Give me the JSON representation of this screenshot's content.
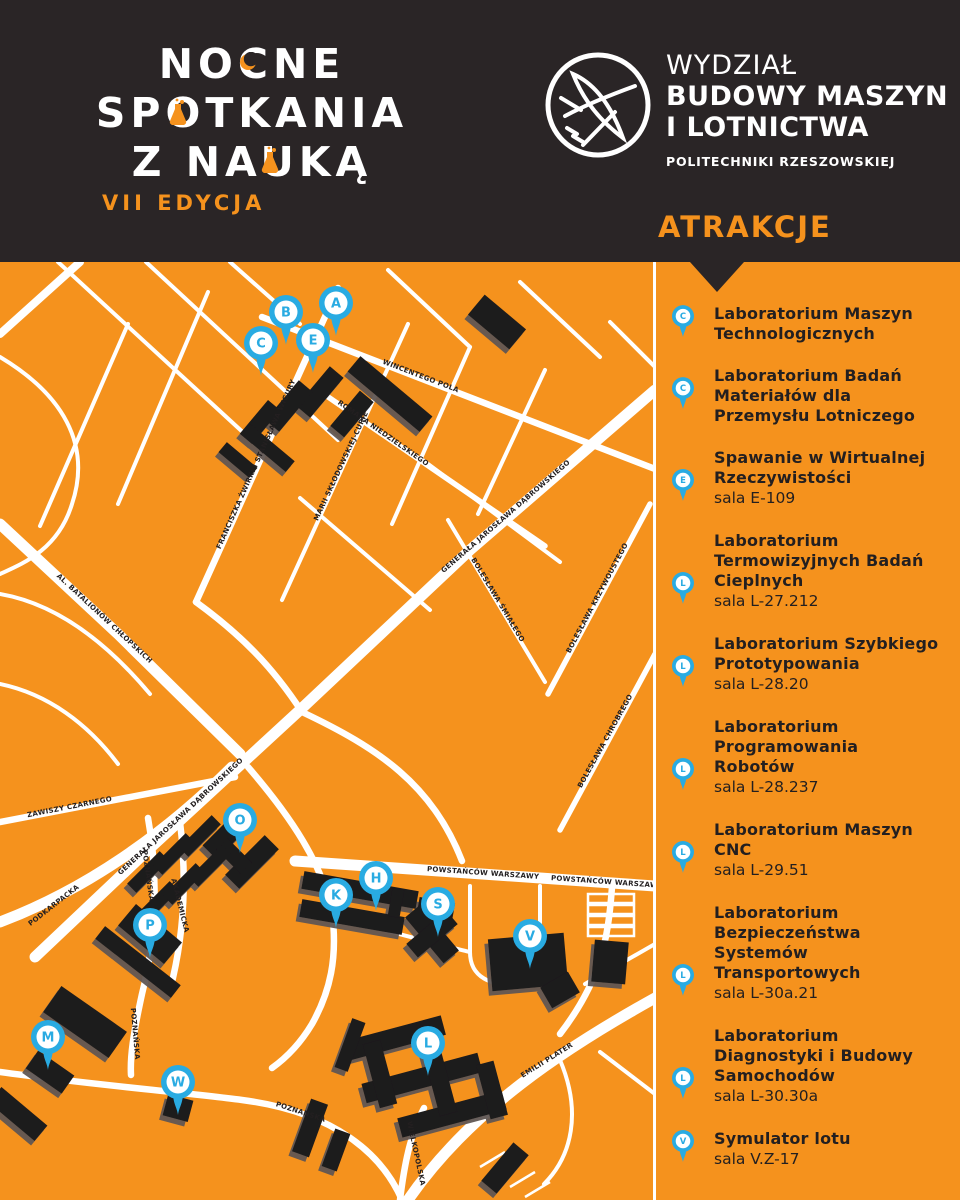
{
  "colors": {
    "orange": "#F5921D",
    "dark": "#2A2526",
    "blue": "#29ABE2",
    "white": "#FFFFFF",
    "ink": "#231F20"
  },
  "poster": {
    "logo": {
      "line1": "NOCNE",
      "line2": "SPOTKANIA",
      "line3": "Z NAUKĄ",
      "edition": "VII EDYCJA"
    },
    "faculty": {
      "line1": "WYDZIAŁ",
      "line2": "BUDOWY MASZYN",
      "line3": "I LOTNICTWA",
      "line4": "POLITECHNIKI RZESZOWSKIEJ"
    },
    "attractions_heading": "ATRAKCJE"
  },
  "map": {
    "pins": [
      {
        "letter": "A",
        "x": 336,
        "y": 41
      },
      {
        "letter": "B",
        "x": 286,
        "y": 50
      },
      {
        "letter": "C",
        "x": 261,
        "y": 81
      },
      {
        "letter": "E",
        "x": 313,
        "y": 78
      },
      {
        "letter": "O",
        "x": 240,
        "y": 558
      },
      {
        "letter": "K",
        "x": 336,
        "y": 633
      },
      {
        "letter": "H",
        "x": 376,
        "y": 616
      },
      {
        "letter": "S",
        "x": 438,
        "y": 642
      },
      {
        "letter": "V",
        "x": 530,
        "y": 674
      },
      {
        "letter": "P",
        "x": 150,
        "y": 663
      },
      {
        "letter": "M",
        "x": 48,
        "y": 775
      },
      {
        "letter": "W",
        "x": 178,
        "y": 820
      },
      {
        "letter": "L",
        "x": 428,
        "y": 781
      }
    ],
    "street_labels": [
      {
        "name": "WINCENTEGO POLA",
        "x": 420,
        "y": 116,
        "rot": 21
      },
      {
        "name": "ROMANA NIEDZIELSKIEGO",
        "x": 382,
        "y": 173,
        "rot": 35
      },
      {
        "name": "FRANCISZKA ŻWIRKI I STANISŁAWA WIGURY",
        "x": 258,
        "y": 203,
        "rot": -66
      },
      {
        "name": "MARII SKŁODOWSKIEJ-CURIE",
        "x": 343,
        "y": 205,
        "rot": -65
      },
      {
        "name": "GENERAŁA JAROSŁAWA DĄBROWSKIEGO",
        "x": 507,
        "y": 256,
        "rot": -41
      },
      {
        "name": "GENERAŁA JAROSŁAWA DĄBROWSKIEGO",
        "x": 182,
        "y": 556,
        "rot": -43
      },
      {
        "name": "AL. BATALIONÓW CHŁOPSKICH",
        "x": 103,
        "y": 358,
        "rot": 43
      },
      {
        "name": "PODKARPACKA",
        "x": 55,
        "y": 645,
        "rot": -38
      },
      {
        "name": "BOLESŁAWA KRZYWOUSTEGO",
        "x": 599,
        "y": 337,
        "rot": -62
      },
      {
        "name": "BOLESŁAWA CHROBREGO",
        "x": 607,
        "y": 480,
        "rot": -61
      },
      {
        "name": "BOLESŁAWA ŚMIAŁEGO",
        "x": 496,
        "y": 339,
        "rot": 59
      },
      {
        "name": "ZAWISZY CZARNEGO",
        "x": 70,
        "y": 547,
        "rot": -11
      },
      {
        "name": "POWSTAŃCÓW WARSZAWY",
        "x": 483,
        "y": 613,
        "rot": 4
      },
      {
        "name": "POWSTAŃCÓW WARSZAWY",
        "x": 607,
        "y": 622,
        "rot": 4
      },
      {
        "name": "EMILII PLATER",
        "x": 548,
        "y": 800,
        "rot": -32
      },
      {
        "name": "POZNAŃSKA",
        "x": 146,
        "y": 614,
        "rot": 82
      },
      {
        "name": "AKADEMICKA",
        "x": 178,
        "y": 644,
        "rot": 76
      },
      {
        "name": "POZNAŃSKA",
        "x": 133,
        "y": 772,
        "rot": 85
      },
      {
        "name": "POZNAŃSKA",
        "x": 300,
        "y": 852,
        "rot": 18
      },
      {
        "name": "WIELKOPOLSKA",
        "x": 414,
        "y": 892,
        "rot": 78
      }
    ]
  },
  "sidebar": {
    "items": [
      {
        "pin": "C",
        "title": "Laboratorium Maszyn\nTechnologicznych",
        "room": ""
      },
      {
        "pin": "C",
        "title": "Laboratorium Badań\nMateriałów dla\nPrzemysłu Lotniczego",
        "room": ""
      },
      {
        "pin": "E",
        "title": "Spawanie w Wirtualnej\nRzeczywistości",
        "room": "sala E-109"
      },
      {
        "pin": "L",
        "title": "Laboratorium\nTermowizyjnych Badań\nCieplnych",
        "room": "sala L-27.212"
      },
      {
        "pin": "L",
        "title": "Laboratorium Szybkiego\nPrototypowania",
        "room": "sala L-28.20"
      },
      {
        "pin": "L",
        "title": "Laboratorium\nProgramowania\nRobotów",
        "room": "sala L-28.237"
      },
      {
        "pin": "L",
        "title": "Laboratorium Maszyn\nCNC",
        "room": "sala L-29.51"
      },
      {
        "pin": "L",
        "title": "Laboratorium\nBezpieczeństwa\nSystemów\nTransportowych",
        "room": "sala L-30a.21"
      },
      {
        "pin": "L",
        "title": "Laboratorium\nDiagnostyki i Budowy\nSamochodów",
        "room": "sala L-30.30a"
      },
      {
        "pin": "V",
        "title": "Symulator lotu",
        "room": "sala V.Z-17"
      }
    ]
  }
}
